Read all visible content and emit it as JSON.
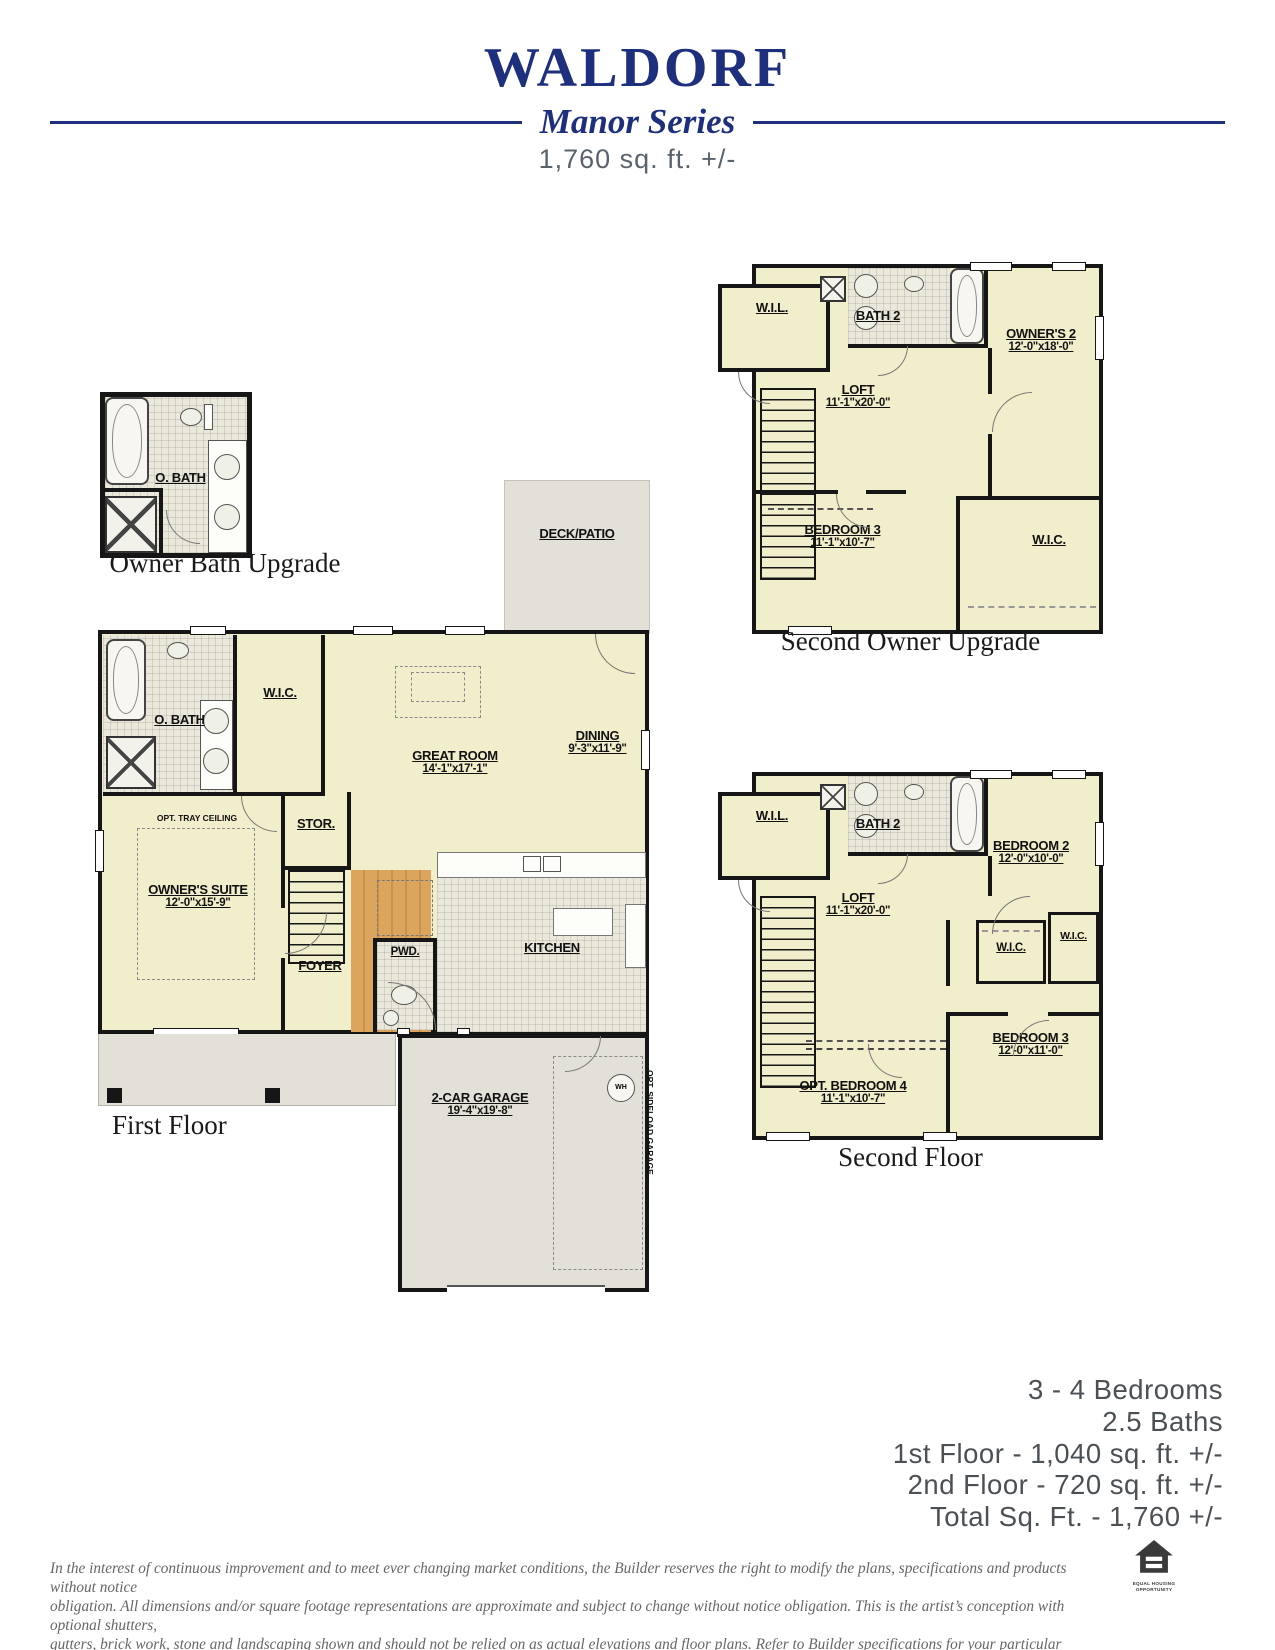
{
  "colors": {
    "navy": "#1e2f7d",
    "cream": "#f1eecb",
    "plan_gray": "#e3e1d7",
    "wall": "#161616",
    "wood": "#d8a055"
  },
  "header": {
    "title": "WALDORF",
    "series": "Manor Series",
    "sqft": "1,760 sq. ft. +/-"
  },
  "plans": {
    "owner_bath": {
      "caption": "Owner Bath Upgrade",
      "obath": "O. BATH"
    },
    "first_floor": {
      "caption": "First Floor",
      "deck": "DECK/PATIO",
      "obath": "O. BATH",
      "wic": "W.I.C.",
      "great_room": "GREAT ROOM",
      "great_room_dims": "14'-1\"x17'-1\"",
      "dining": "DINING",
      "dining_dims": "9'-3\"x11'-9\"",
      "opt_tray": "OPT. TRAY CEILING",
      "owners_suite": "OWNER'S SUITE",
      "owners_suite_dims": "12'-0\"x15'-9\"",
      "stor": "STOR.",
      "foyer": "FOYER",
      "pwd": "PWD.",
      "kitchen": "KITCHEN",
      "garage": "2-CAR GARAGE",
      "garage_dims": "19'-4\"x19'-8\"",
      "opt_sideload": "OPT. SIDELOAD GARAGE",
      "wh": "WH"
    },
    "second_owner": {
      "caption": "Second Owner Upgrade",
      "wil": "W.I.L.",
      "bath2": "BATH 2",
      "owners2": "OWNER'S 2",
      "owners2_dims": "12'-0\"x18'-0\"",
      "loft": "LOFT",
      "loft_dims": "11'-1\"x20'-0\"",
      "bedroom3": "BEDROOM 3",
      "bedroom3_dims": "11'-1\"x10'-7\"",
      "wic": "W.I.C."
    },
    "second_floor": {
      "caption": "Second Floor",
      "wil": "W.I.L.",
      "bath2": "BATH 2",
      "bedroom2": "BEDROOM 2",
      "bedroom2_dims": "12'-0\"x10'-0\"",
      "loft": "LOFT",
      "loft_dims": "11'-1\"x20'-0\"",
      "wic1": "W.I.C.",
      "wic2": "W.I.C.",
      "opt_bedroom4": "OPT. BEDROOM 4",
      "opt_bedroom4_dims": "11'-1\"x10'-7\"",
      "bedroom3": "BEDROOM 3",
      "bedroom3_dims": "12'-0\"x11'-0\""
    }
  },
  "stats": {
    "line1": "3 - 4 Bedrooms",
    "line2": "2.5 Baths",
    "line3": "1st Floor - 1,040 sq. ft. +/-",
    "line4": "2nd Floor - 720 sq. ft. +/-",
    "line5": "Total Sq. Ft. - 1,760 +/-"
  },
  "disclaimer": {
    "line1": "In the interest of continuous improvement and to meet ever changing market conditions, the Builder reserves the right to modify the plans,  specifications and products without notice",
    "line2": "obligation. All dimensions and/or square footage representations are approximate and subject to change without notice obligation. This is the artist’s conception with optional shutters,",
    "line3": "gutters, brick work, stone and landscaping shown and should not be relied on as actual elevations and floor plans. Refer to Builder specifications for your particular community. 090125"
  },
  "eho": {
    "line1": "EQUAL HOUSING",
    "line2": "OPPORTUNITY"
  }
}
